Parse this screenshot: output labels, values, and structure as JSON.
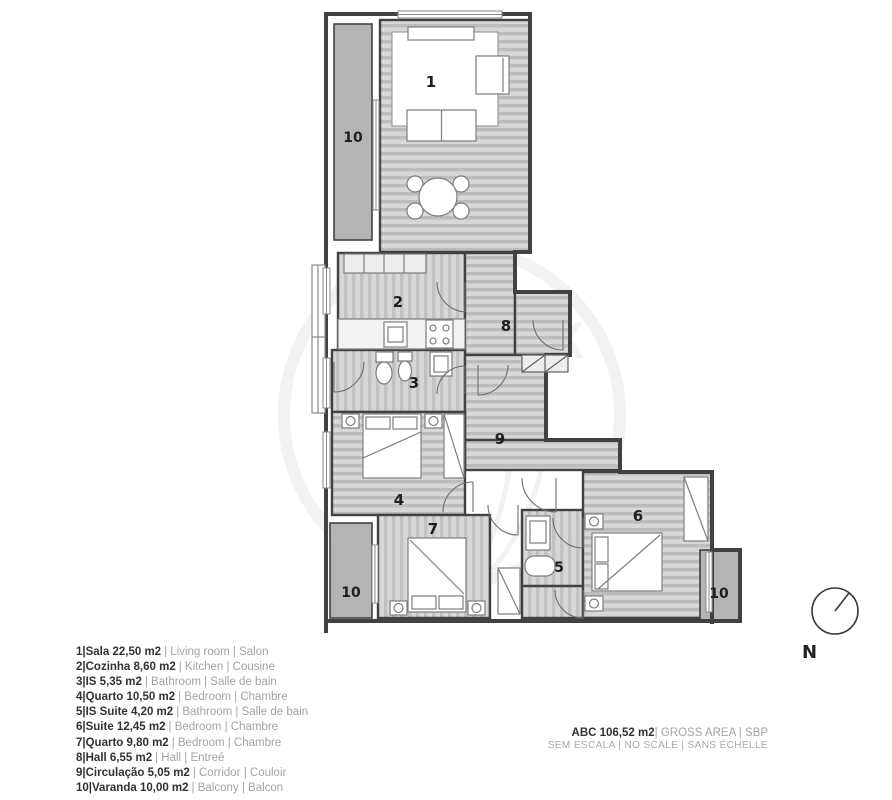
{
  "plan": {
    "room_labels": {
      "r1": "1",
      "r2": "2",
      "r3": "3",
      "r4": "4",
      "r5": "5",
      "r6": "6",
      "r7": "7",
      "r8": "8",
      "r9": "9",
      "r10a": "10",
      "r10b": "10",
      "r10c": "10"
    },
    "watermark": {
      "left": "RE",
      "mid": "M",
      "right": "AX",
      "registered": "®"
    }
  },
  "legend": {
    "items": [
      {
        "primary": "1|Sala 22,50 m2",
        "secondary": "| Living room | Salon"
      },
      {
        "primary": "2|Cozinha 8,60 m2",
        "secondary": "| Kitchen | Cousine"
      },
      {
        "primary": "3|IS 5,35 m2",
        "secondary": "| Bathroom | Salle de bain"
      },
      {
        "primary": "4|Quarto 10,50 m2",
        "secondary": "| Bedroom | Chambre"
      },
      {
        "primary": "5|IS Suite 4,20 m2",
        "secondary": "| Bathroom | Salle de bain"
      },
      {
        "primary": "6|Suite 12,45 m2",
        "secondary": "| Bedroom | Chambre"
      },
      {
        "primary": "7|Quarto 9,80 m2",
        "secondary": "| Bedroom | Chambre"
      },
      {
        "primary": "8|Hall 6,55 m2",
        "secondary": "| Hall | Entreé"
      },
      {
        "primary": "9|Circulação 5,05 m2",
        "secondary": "| Corridor | Couloir"
      },
      {
        "primary": "10|Varanda 10,00 m2",
        "secondary": "| Balcony | Balcon"
      }
    ]
  },
  "footer": {
    "area_primary": "ABC 106,52 m2",
    "area_secondary": "| GROSS AREA | SBP",
    "scale_note": "SEM ESCALA | NO SCALE | SANS ÉCHELLE"
  },
  "compass": {
    "north_label": "N"
  },
  "colors": {
    "wall": "#414141",
    "floor_base": "#d7d7d7",
    "floor_stripe": "#bcbcbc",
    "balcony_fill": "#b4b4b4",
    "text_dark": "#323232",
    "text_muted": "#a3a3a3"
  }
}
